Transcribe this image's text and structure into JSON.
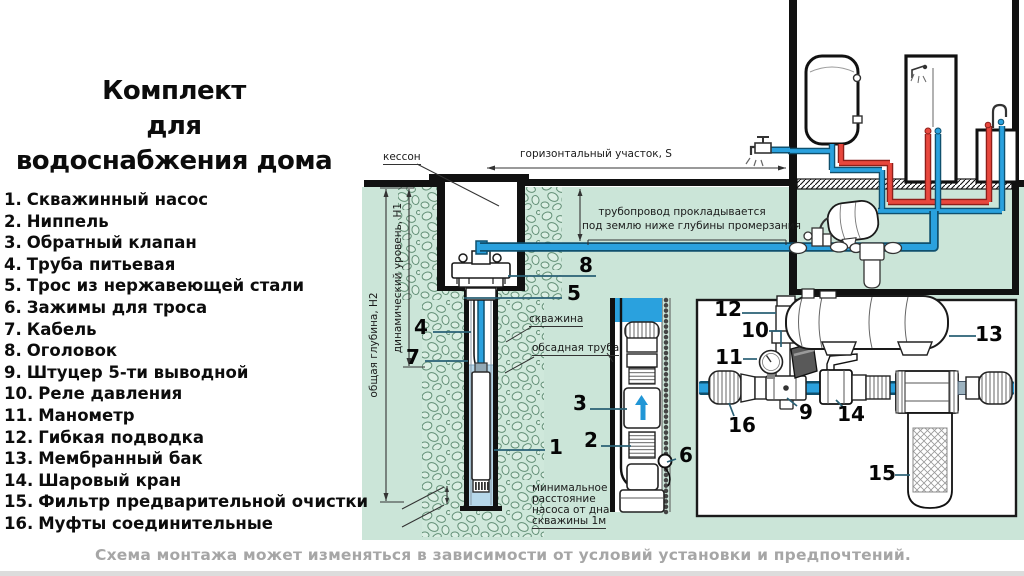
{
  "title": {
    "line1": "Комплект",
    "line2": "для",
    "line3": "водоснабжения дома"
  },
  "legend": {
    "items": [
      {
        "num": "1.",
        "label": "Скважинный насос"
      },
      {
        "num": "2.",
        "label": "Ниппель"
      },
      {
        "num": "3.",
        "label": "Обратный клапан"
      },
      {
        "num": "4.",
        "label": "Труба питьевая"
      },
      {
        "num": "5.",
        "label": "Трос из нержавеющей стали"
      },
      {
        "num": "6.",
        "label": "Зажимы для троса"
      },
      {
        "num": "7.",
        "label": "Кабель"
      },
      {
        "num": "8.",
        "label": "Оголовок"
      },
      {
        "num": "9.",
        "label": "Штуцер 5-ти выводной"
      },
      {
        "num": "10.",
        "label": "Реле давления"
      },
      {
        "num": "11.",
        "label": "Манометр"
      },
      {
        "num": "12.",
        "label": "Гибкая подводка"
      },
      {
        "num": "13.",
        "label": "Мембранный бак"
      },
      {
        "num": "14.",
        "label": "Шаровый кран"
      },
      {
        "num": "15.",
        "label": "Фильтр предварительной очистки"
      },
      {
        "num": "16.",
        "label": "Муфты соединительные"
      }
    ]
  },
  "diagram": {
    "labels": {
      "caisson": "кессон",
      "horizontal_section": "горизонтальный участок, S",
      "pipeline_note_1": "трубопровод прокладывается",
      "pipeline_note_2": "под землю ниже глубины промерзания",
      "total_depth": "общая глубина, Н2",
      "dynamic_level": "динамический уровень, Н1",
      "borehole": "скважина",
      "casing_pipe": "обсадная труба",
      "min_distance_1": "минимальное",
      "min_distance_2": "расстояние",
      "min_distance_3": "насоса от дна",
      "min_distance_4": "скважины 1м"
    },
    "callouts": {
      "n1": "1",
      "n2": "2",
      "n3": "3",
      "n4": "4",
      "n5": "5",
      "n6": "6",
      "n7": "7",
      "n8": "8",
      "n9": "9",
      "n10": "10",
      "n11": "11",
      "n12": "12",
      "n13": "13",
      "n14": "14",
      "n15": "15",
      "n16": "16"
    }
  },
  "caption": "Схема монтажа может изменяться в зависимости от условий установки и предпочтений.",
  "palette": {
    "ground_green": "#cbe5d8",
    "pipe_blue": "#2aa1de",
    "pipe_blue_dark": "#0f506e",
    "hot_red": "#e8473d",
    "water_light_blue": "#b7d8ea",
    "line_black": "#1a1a1a",
    "leader_teal": "#2a6075",
    "caption_gray": "#a6a6a6"
  }
}
